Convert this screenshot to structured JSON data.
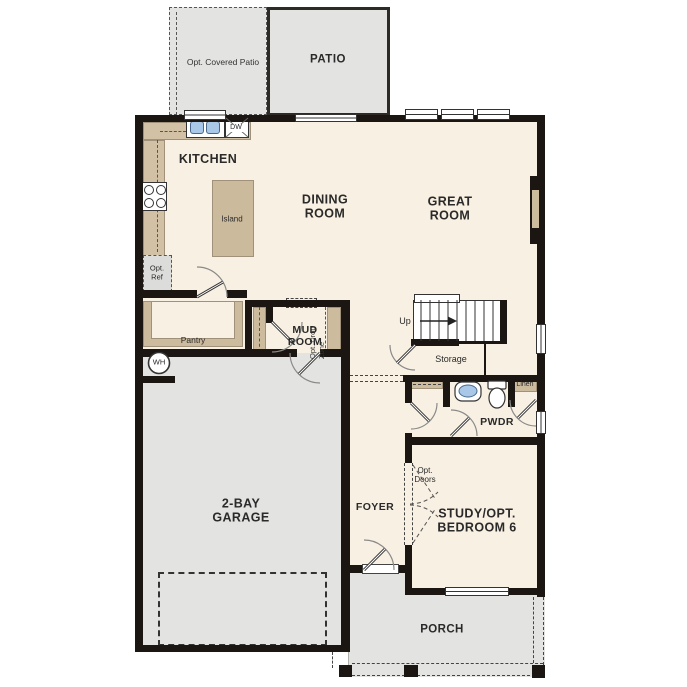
{
  "labels": {
    "patio": "PATIO",
    "opt_covered_patio": "Opt. Covered Patio",
    "kitchen": "KITCHEN",
    "dining_room": "DINING\nROOM",
    "great_room": "GREAT\nROOM",
    "island": "Island",
    "dw": "DW",
    "opt_ref": "Opt.\nRef",
    "pantry": "Pantry",
    "wh": "WH",
    "mud_room": "MUD\nROOM",
    "opt_drop_zone": "Opt. Drop\nZone",
    "up": "Up",
    "storage": "Storage",
    "pwdr": "PWDR",
    "linen": "Linen",
    "garage": "2-BAY\nGARAGE",
    "foyer": "FOYER",
    "study": "STUDY/OPT.\nBEDROOM 6",
    "opt_doors": "Opt.\nDoors",
    "porch": "PORCH"
  },
  "colors": {
    "wall": "#1b1611",
    "floor": "#f8f0e2",
    "cabinet_tan": "#d3c1a5",
    "outdoor_gray": "#e3e3e1",
    "fixture_blue": "#a9c7e6"
  }
}
